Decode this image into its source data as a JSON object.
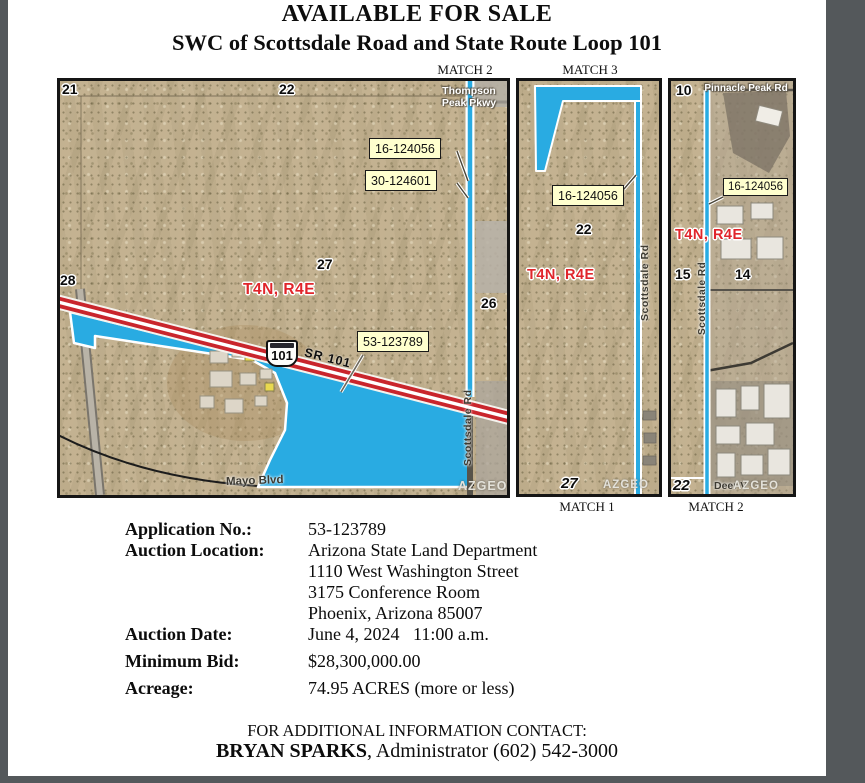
{
  "header": {
    "title": "AVAILABLE FOR SALE",
    "subtitle": "SWC of Scottsdale Road and State Route Loop 101"
  },
  "match_labels": {
    "top_left": "MATCH 2",
    "top_middle": "MATCH 3",
    "bottom_middle": "MATCH 1",
    "bottom_right": "MATCH 2"
  },
  "map_left": {
    "section_21": "21",
    "section_22": "22",
    "section_26": "26",
    "section_27": "27",
    "section_28": "28",
    "township": "T4N, R4E",
    "callout_1": "16-124056",
    "callout_2": "30-124601",
    "callout_3": "53-123789",
    "road_thompson_line1": "Thompson",
    "road_thompson_line2": "Peak Pkwy",
    "highway_shield": "101",
    "road_sr101": "SR 101",
    "road_scottsdale": "Scottsdale Rd",
    "road_mayo": "Mayo Blvd",
    "watermark": "AZGEO"
  },
  "map_middle": {
    "section_22": "22",
    "section_27": "27",
    "township": "T4N, R4E",
    "callout_1": "16-124056",
    "road_scottsdale": "Scottsdale Rd",
    "watermark": "AZGEO"
  },
  "map_right": {
    "section_10": "10",
    "section_14": "14",
    "section_15": "15",
    "section_22": "22",
    "township": "T4N, R4E",
    "callout_1": "16-124056",
    "road_pinnacle": "Pinnacle Peak Rd",
    "road_scottsdale": "Scottsdale Rd",
    "road_deer": "Deer V",
    "watermark": "AZGEO"
  },
  "details": {
    "application_label": "Application No.:",
    "application_value": "53-123789",
    "location_label": "Auction Location:",
    "location_line1": "Arizona State Land Department",
    "location_line2": "1110 West Washington Street",
    "location_line3": "3175 Conference Room",
    "location_line4": "Phoenix, Arizona 85007",
    "date_label": "Auction Date:",
    "date_value": "June 4, 2024   11:00 a.m.",
    "bid_label": "Minimum Bid:",
    "bid_value": "$28,300,000.00",
    "acreage_label": "Acreage:",
    "acreage_value": "74.95 ACRES (more or less)"
  },
  "footer": {
    "contact_heading": "FOR ADDITIONAL INFORMATION CONTACT:",
    "contact_name": "BRYAN SPARKS",
    "contact_rest": ", Administrator (602) 542-3000"
  },
  "colors": {
    "property_blue": "#29abe2",
    "highway_red": "#c9252c",
    "callout_yellow": "#ffffce",
    "township_red": "#e0252b",
    "terrain_tan": "#c4b291",
    "background_gray": "#54585b"
  }
}
